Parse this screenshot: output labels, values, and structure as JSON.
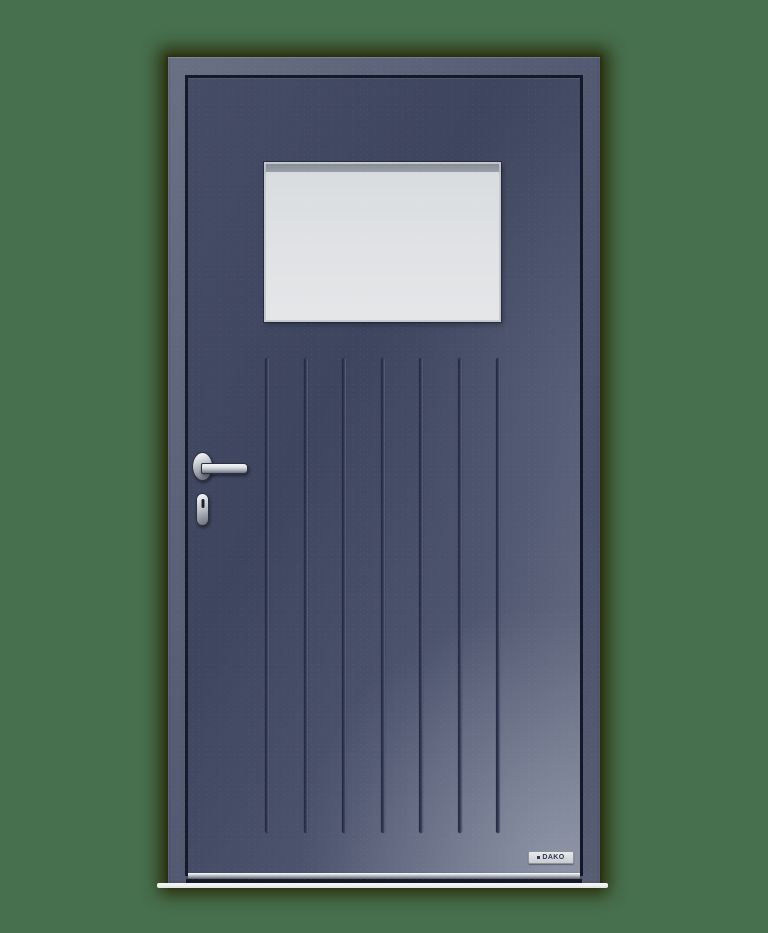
{
  "scene": {
    "description_label": "",
    "object_count": 1
  },
  "door": {
    "brand_label": "DAKO",
    "groove_count": 7
  },
  "colors": {
    "background": "#47704e",
    "door_shadow": "#2b2e0c",
    "frame_light": "#6a7084",
    "frame_mid": "#565d75",
    "frame_dark": "#4a516b",
    "leaf_light": "#6f7589",
    "leaf_mid": "#454c66",
    "leaf_dark": "#3e455f",
    "recess": "#141929",
    "glass": "#dfe1e4",
    "glazing_bead": "#9aa0a9",
    "window_frame": "#c6c9cf",
    "groove_dark": "#20263c",
    "groove_light": "#5f6680",
    "chrome_light": "#f2f4f6",
    "chrome_mid": "#b9bec6",
    "chrome_dark": "#6f7480",
    "hardware_outline": "#2c3140",
    "threshold_light": "#dfe2e6",
    "threshold_dark": "#565c68",
    "floor_strip": "#eef0f1",
    "brand_plate_bg": "#c8cbd0",
    "brand_text": "#2e3552"
  },
  "groove_layout": {
    "start_px": 77,
    "spacing_px": 38.5
  }
}
